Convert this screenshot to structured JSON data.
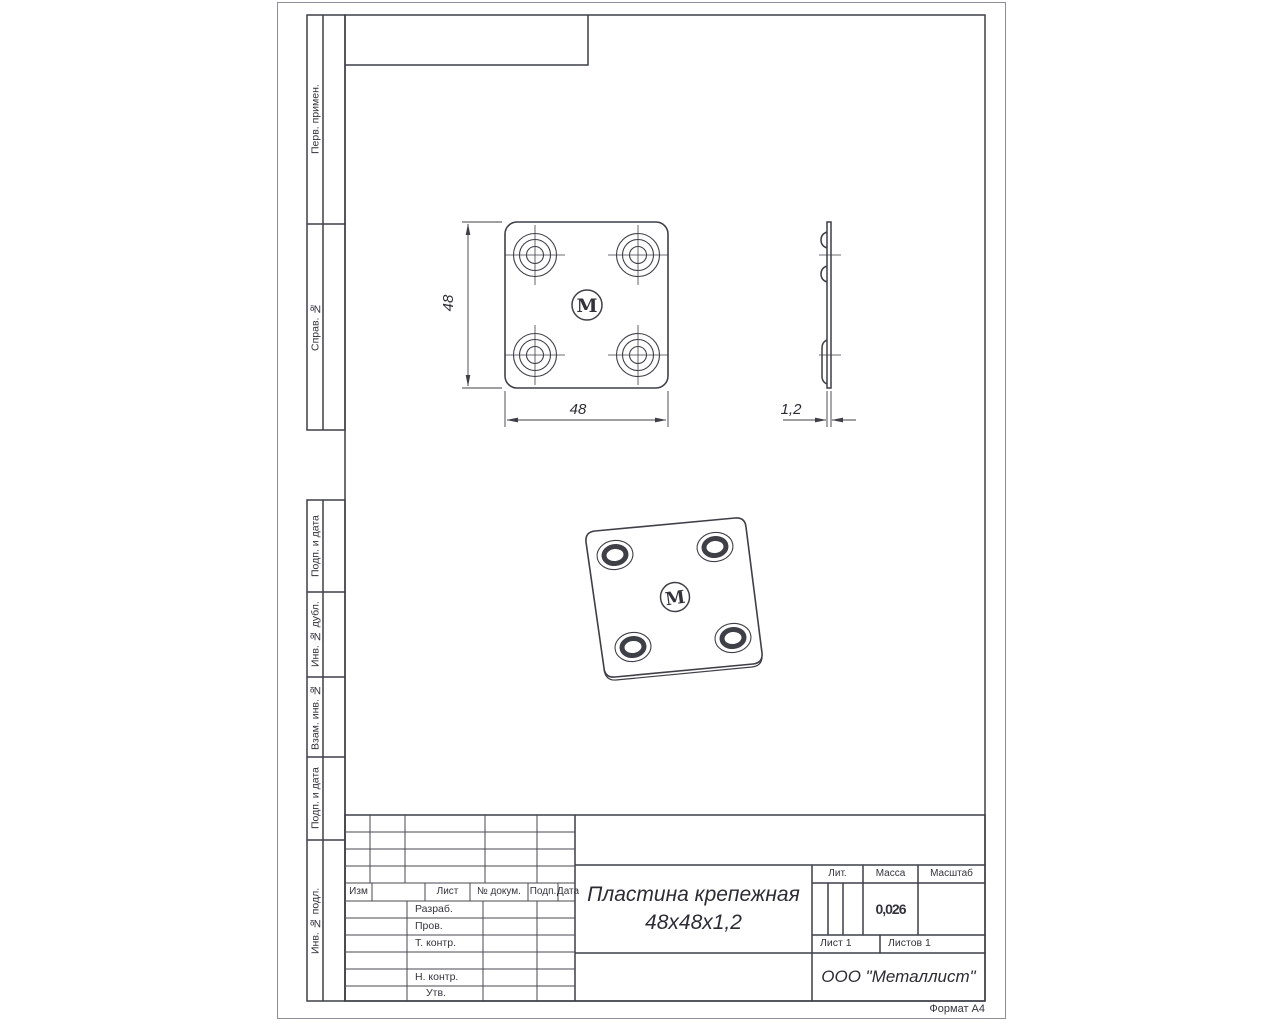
{
  "sheet": {
    "format_label": "Формат А4"
  },
  "sidebar": {
    "cells": [
      {
        "label": "Перв. примен."
      },
      {
        "label": "Справ. №"
      },
      {
        "label": "Подп. и дата"
      },
      {
        "label": "Инв. № дубл."
      },
      {
        "label": "Взам. инв. №"
      },
      {
        "label": "Подп. и дата"
      },
      {
        "label": "Инв. № подл."
      }
    ]
  },
  "views": {
    "front": {
      "dim_width": "48",
      "dim_height": "48",
      "logo_letter": "M"
    },
    "side": {
      "dim_thickness": "1,2"
    },
    "iso": {
      "logo_letter": "M"
    }
  },
  "title_block": {
    "revision_header": {
      "izm": "Изм",
      "list": "Лист",
      "doc": "№ докум.",
      "sign": "Подп.",
      "date": "Дата"
    },
    "roles": [
      "Разраб.",
      "Пров.",
      "Т. контр.",
      "",
      "Н. контр.",
      "Утв."
    ],
    "title_line1": "Пластина крепежная",
    "title_line2": "48х48х1,2",
    "lit_label": "Лит.",
    "mass_label": "Масса",
    "scale_label": "Масштаб",
    "mass_value": "0,026",
    "sheet_no": "Лист 1",
    "sheets_total": "Листов 1",
    "company": "ООО \"Металлист\""
  },
  "colors": {
    "line": "#3f3f48",
    "paper": "#ffffff"
  }
}
